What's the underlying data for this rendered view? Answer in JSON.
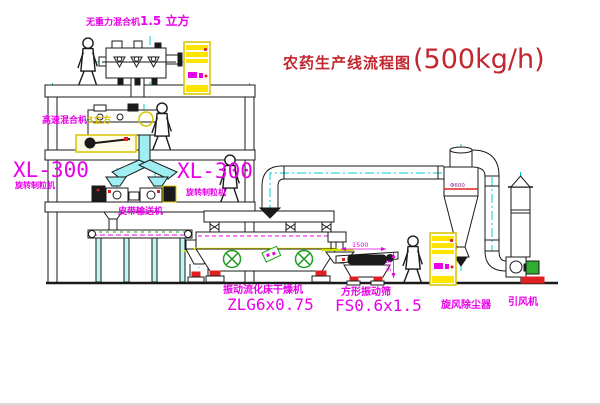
{
  "title": {
    "name": "农药生产线流程图",
    "capacity": "(500kg/h)"
  },
  "colors": {
    "label_magenta": "#e800e8",
    "title_red": "#c2262e",
    "cad_cyan": "#00cfcf",
    "cabinet_yellow": "#ffe400",
    "motor_green": "#1e9e1e",
    "alert_red": "#e02020"
  },
  "equipment": {
    "gravity_free_mixer": {
      "label": "无重力混合机",
      "volume": "1.5 立方"
    },
    "high_speed_mixer": {
      "label": "高速混合机",
      "volume": "3立方"
    },
    "granulator_left": {
      "model": "XL-300",
      "label": "旋转制粒机"
    },
    "granulator_mid": {
      "model": "XL-300",
      "label": "旋转制粒机"
    },
    "belt_conveyor": {
      "label": "皮带输送机"
    },
    "fluid_bed_dryer": {
      "label": "振动流化床干燥机",
      "model": "ZLG6x0.75"
    },
    "vibrating_screen": {
      "label": "方形振动筛",
      "model": "FS0.6x1.5",
      "dim_length": "1500",
      "dim_height": "545"
    },
    "cyclone": {
      "label": "旋风除尘器",
      "dim": "Φ600"
    },
    "fan": {
      "label": "引风机"
    }
  }
}
